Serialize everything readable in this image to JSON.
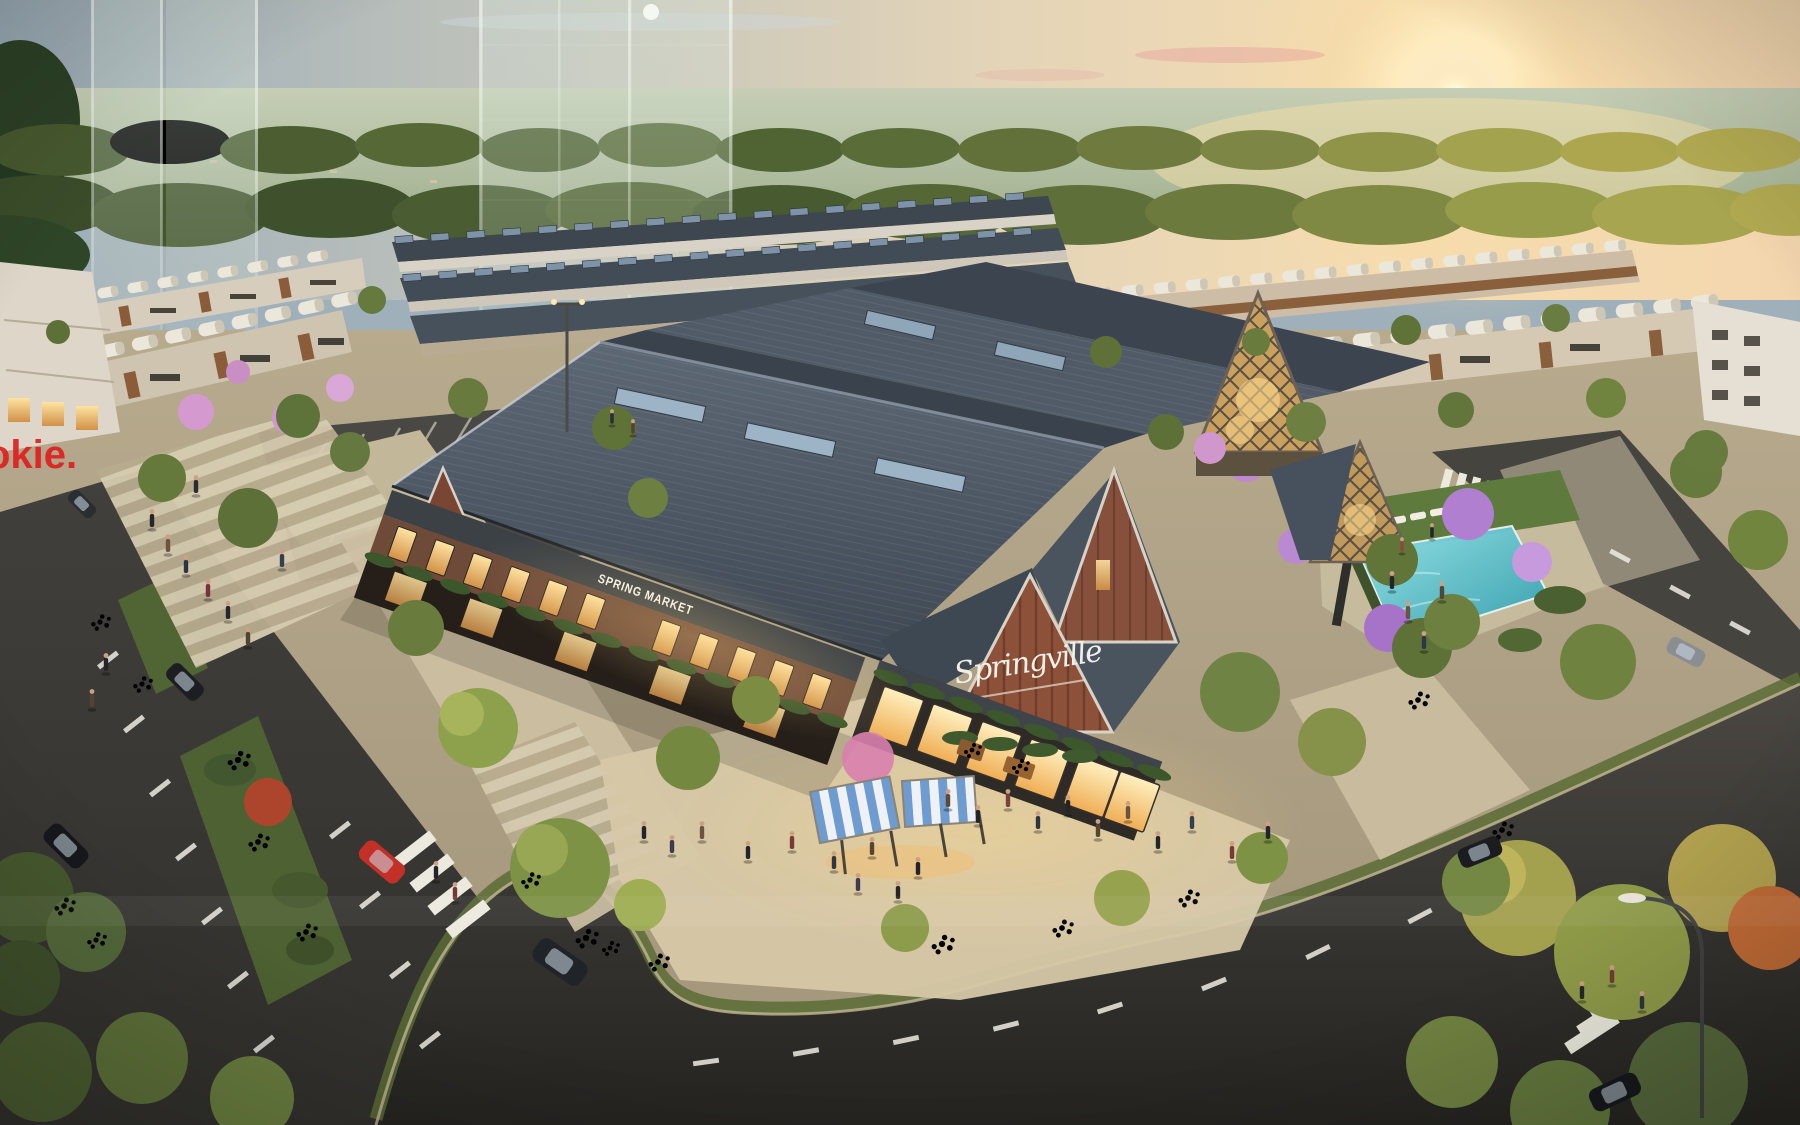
{
  "signs": {
    "spring_market": "SPRING MARKET",
    "springville": "Springville",
    "watermark": "okie."
  },
  "palette": {
    "sky_cool": "#9bacb8",
    "sky_warm": "#f6dcb0",
    "sun_core": "#fffef8",
    "forest_green": "#4c5f33",
    "roof_slate": "#4b5663",
    "brick": "#8a4f3a",
    "window_glow": "#ffd992",
    "pool_water": "#3fb5c4",
    "asphalt": "#3b3a37",
    "paving": "#c9bda1",
    "canopy_blue": "#6e9bd0",
    "car_red": "#c33028",
    "flower_orange": "#d4652a",
    "blossom_pink": "#d9a0d4",
    "watermark_red": "#e01f1f"
  }
}
